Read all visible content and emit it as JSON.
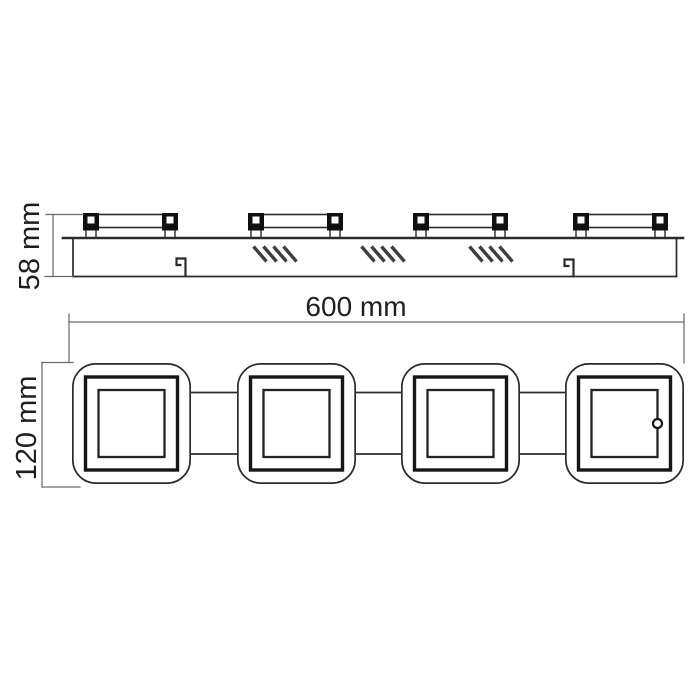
{
  "drawing": {
    "kind": "technical-dimension-drawing",
    "subject": "four-head ceiling light fixture",
    "views": {
      "side_view": {
        "height_dimension": {
          "label": "58 mm"
        },
        "bracket_count": 4,
        "vent_hatch_group_count": 3,
        "clip_hook_count": 2
      },
      "front_view": {
        "width_dimension": {
          "label": "600 mm"
        },
        "height_dimension": {
          "label": "120 mm"
        },
        "lamp_head_count": 4
      }
    }
  },
  "colors": {
    "background": "#ffffff",
    "outline": "#2b2b2b",
    "dim_line": "#6a6a6a",
    "text": "#1f1f1f",
    "post_fill": "#101010",
    "hatch": "#3d3d3d"
  }
}
